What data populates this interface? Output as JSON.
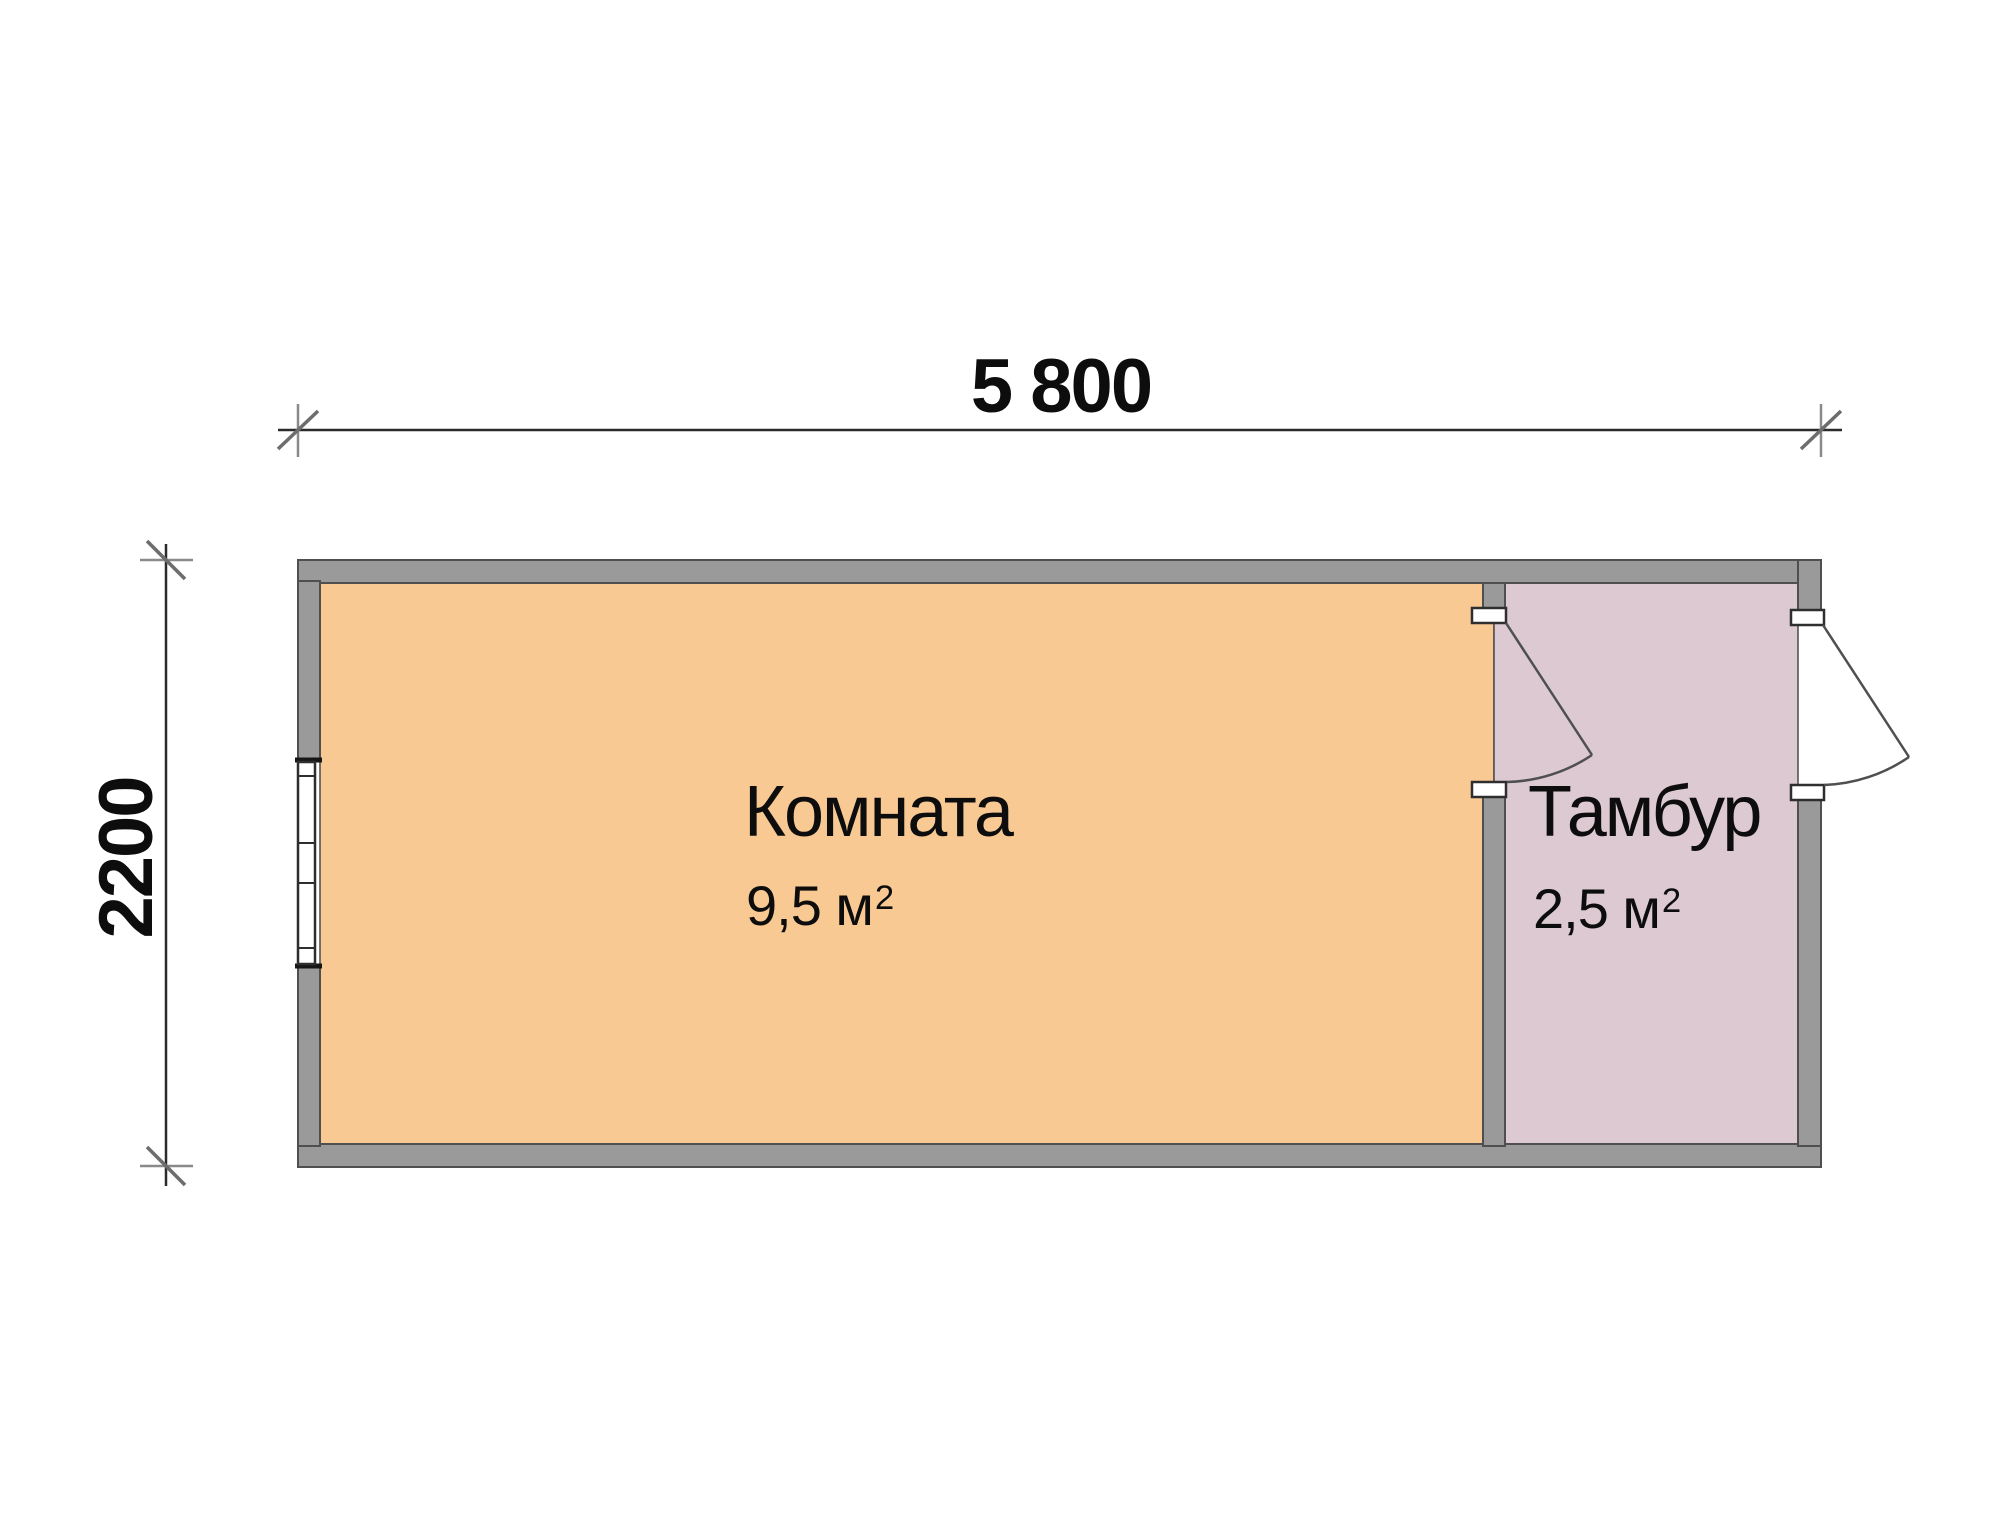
{
  "plan_title": "Floor plan of a cabin with room and vestibule",
  "dimensions": {
    "width_label": "5 800",
    "height_label": "2200"
  },
  "rooms": [
    {
      "id": "komnata",
      "label": "Комната",
      "area": "9,5 м",
      "area_exponent": "2"
    },
    {
      "id": "tambur",
      "label": "Тамбур",
      "area": "2,5 м",
      "area_exponent": "2"
    }
  ],
  "colors": {
    "background": "#ffffff",
    "room_komnata": "#f9c993",
    "room_tambur": "#dcc9d1",
    "wall": "#9a9a9a",
    "outline": "#4f4f4f",
    "text": "#0d0d0d"
  }
}
